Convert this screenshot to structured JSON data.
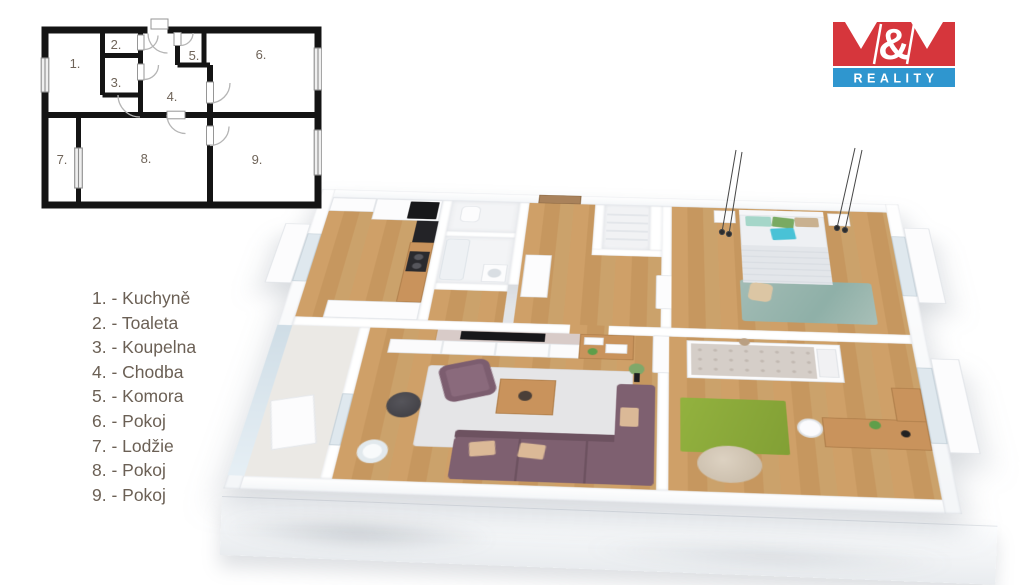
{
  "logo": {
    "mm": "M&M",
    "amp": "&",
    "reality": "REALITY",
    "red": "#d6363c",
    "blue": "#2f96cf"
  },
  "legend": {
    "items": [
      {
        "num": "1.",
        "name": "Kuchyně",
        "label": "1. - Kuchyně"
      },
      {
        "num": "2.",
        "name": "Toaleta",
        "label": "2. - Toaleta"
      },
      {
        "num": "3.",
        "name": "Koupelna",
        "label": "3. - Koupelna"
      },
      {
        "num": "4.",
        "name": "Chodba",
        "label": "4. - Chodba"
      },
      {
        "num": "5.",
        "name": "Komora",
        "label": "5. - Komora"
      },
      {
        "num": "6.",
        "name": "Pokoj",
        "label": "6. - Pokoj"
      },
      {
        "num": "7.",
        "name": "Lodžie",
        "label": "7. - Lodžie"
      },
      {
        "num": "8.",
        "name": "Pokoj",
        "label": "8. - Pokoj"
      },
      {
        "num": "9.",
        "name": "Pokoj",
        "label": "9. - Pokoj"
      }
    ]
  },
  "colors": {
    "plan_lines": "#141414",
    "legend_text": "#6b6055",
    "wood_floor": "#c89a62",
    "wall_white": "#ffffff",
    "sofa_mauve": "#7e6070",
    "rug_living_gray": "#e5e5e7",
    "rug_green": "#8fae3e",
    "rug_bedroom_teal": "#9ab5ae",
    "bean_bag": "#cdc1b0",
    "loggia_glass": "#cfdde6"
  }
}
